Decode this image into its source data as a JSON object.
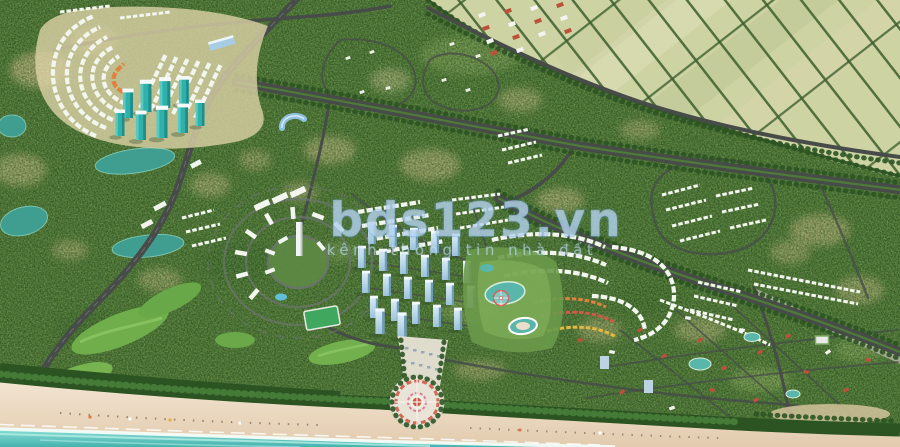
{
  "watermark": {
    "brand": "bds123.vn",
    "tagline": "kênh thông tin nhà đất"
  },
  "palette": {
    "forest": "#4a7433",
    "forest_dark": "#2c5423",
    "meadow": "#9ab868",
    "sand_patch": "#d6c28e",
    "field": "#ced3a4",
    "hedge": "#3a5c2b",
    "road": "#474c49",
    "road_pale": "#b5b1a3",
    "median": "#4e7a37",
    "building": "#f3f5ef",
    "tower_blue_light": "#d8ebf6",
    "tower_blue": "#9cc2d9",
    "tower_blue_dark": "#6f9cba",
    "tower_teal": "#2fb0ab",
    "accent_orange": "#e0823f",
    "accent_red": "#cf5a48",
    "accent_yellow": "#e3b93f",
    "lake": "#3f9e90",
    "pond": "#58b6ab",
    "golf": "#6fae4b",
    "beach_sand": "#f2e4d0",
    "beach_sand_deep": "#e2cbae",
    "sea": "#8adfd6",
    "sea_deep": "#46b2ae",
    "foam": "#f3fcf8",
    "plaza_pave": "#e8e3d6"
  }
}
